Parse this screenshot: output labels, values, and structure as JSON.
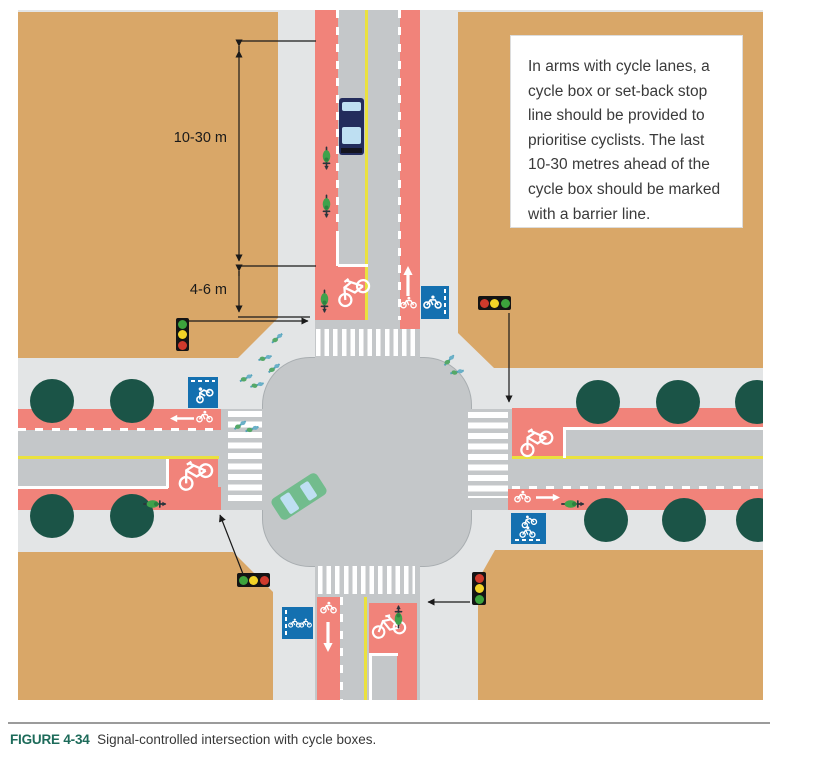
{
  "note_box": {
    "text": "In arms with cycle lanes, a cycle box or set-back stop line should be provided to prioritise cyclists. The last 10-30 metres ahead of the cycle box should be marked with a barrier line."
  },
  "dimension_labels": {
    "barrier_line_length": "10-30 m",
    "cycle_box_depth": "4-6 m"
  },
  "caption": {
    "figure_label": "FIGURE 4-34",
    "text": "Signal-controlled intersection with cycle boxes."
  },
  "palette": {
    "building": "#d9a768",
    "sidewalk": "#e3e5e6",
    "road": "#c4c7c9",
    "cycle_lane": "#f1837a",
    "lane_yellow": "#eae13e",
    "tree": "#1b5447",
    "sign_blue": "#1470b0",
    "traffic_red": "#cf3a2c",
    "traffic_amber": "#f2d327",
    "traffic_green": "#3da33c",
    "truck": "#232c5c",
    "car": "#72bc8d",
    "glass": "#bedff2",
    "cyclist_green": "#3fa24b"
  }
}
